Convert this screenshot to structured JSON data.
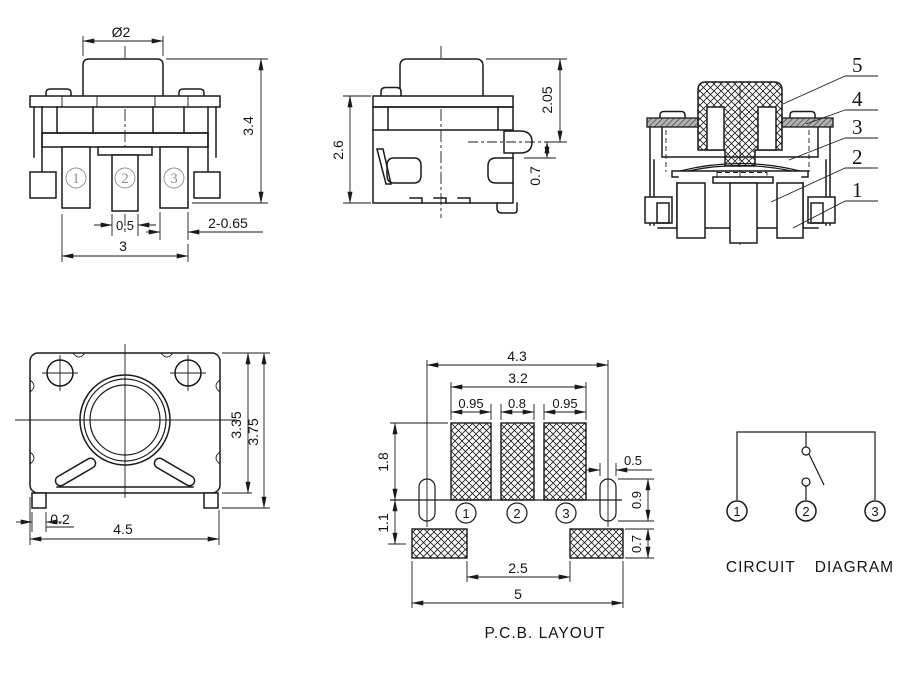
{
  "front": {
    "dia": "Ø2",
    "height": "3.4",
    "pin_w": "0.5",
    "pin_note": "2-0.65",
    "span": "3",
    "t1": "1",
    "t2": "2",
    "t3": "3"
  },
  "side": {
    "height": "2.6",
    "upper": "2.05",
    "pin": "0.7"
  },
  "section": {
    "c5": "5",
    "c4": "4",
    "c3": "3",
    "c2": "2",
    "c1": "1"
  },
  "bottom": {
    "inner_h": "3.35",
    "outer_h": "3.75",
    "foot": "0.2",
    "width": "4.5"
  },
  "pcb": {
    "caption": "P.C.B. LAYOUT",
    "w1": "4.3",
    "w2": "3.2",
    "p1": "0.95",
    "p2": "0.8",
    "p3": "0.95",
    "h1": "1.8",
    "h2": "1.1",
    "slot_w": "0.5",
    "slot_h": "0.9",
    "pad_h": "0.7",
    "gap": "2.5",
    "w3": "5",
    "t1": "1",
    "t2": "2",
    "t3": "3"
  },
  "circuit": {
    "caption": "CIRCUIT DIAGRAM",
    "t1": "1",
    "t2": "2",
    "t3": "3"
  },
  "colors": {
    "line": "#1a1a1a",
    "gray": "#8f8f8f"
  }
}
